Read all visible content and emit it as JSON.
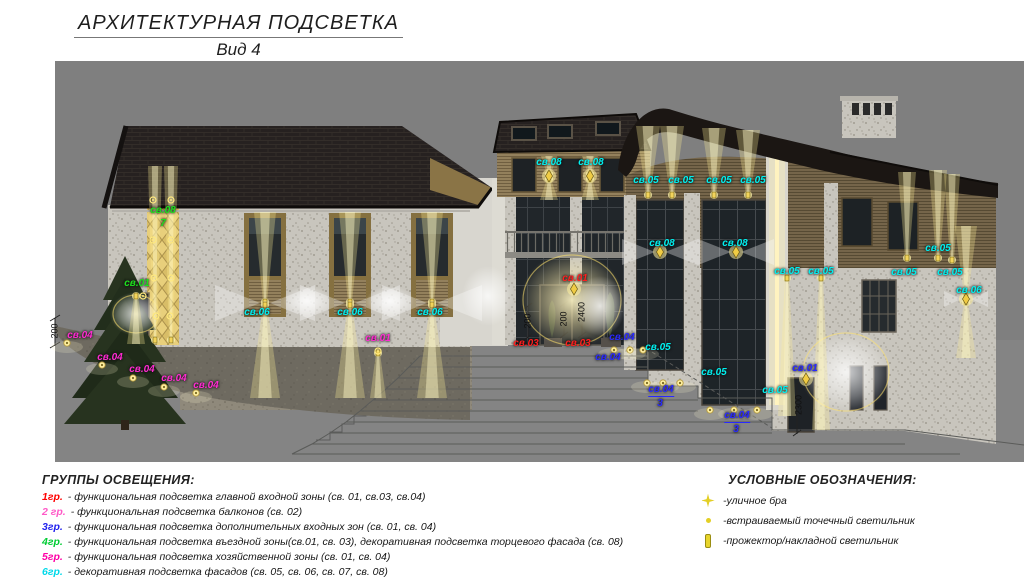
{
  "title": {
    "line1": "АРХИТЕКТУРНАЯ ПОДСВЕТКА",
    "line2": "Вид 4"
  },
  "groups_legend": {
    "header": "ГРУППЫ ОСВЕЩЕНИЯ:",
    "items": [
      {
        "code": "1гр.",
        "color": "#ff0000",
        "desc": "- функциональная подсветка главной входной зоны (св. 01, св.03, св.04)"
      },
      {
        "code": "2 гр.",
        "color": "#ff59c7",
        "desc": "- функциональная подсветка балконов (св. 02)"
      },
      {
        "code": "3гр.",
        "color": "#2222ee",
        "desc": "- функциональная подсветка дополнительных входных зон (св. 01, св. 04)"
      },
      {
        "code": "4гр.",
        "color": "#00cc33",
        "desc": "- функциональная подсветка въездной зоны(св.01, св. 03), декоративная подсветка торцевого фасада (св. 08)"
      },
      {
        "code": "5гр.",
        "color": "#ff00a6",
        "desc": "- функциональная подсветка хозяйственной зоны (св. 01, св. 04)"
      },
      {
        "code": "6гр.",
        "color": "#00d9e9",
        "desc": "- декоративная подсветка фасадов (св. 05, св. 06, св. 07, св. 08)"
      }
    ]
  },
  "symbols_legend": {
    "header": "УСЛОВНЫЕ ОБОЗНАЧЕНИЯ:",
    "items": [
      {
        "icon": "street-sconce-icon",
        "label": "-уличное бра"
      },
      {
        "icon": "recessed-point-icon",
        "label": "-встраиваемый точечный светильник"
      },
      {
        "icon": "floodlight-icon",
        "label": "-прожектор/накладной светильник"
      }
    ]
  },
  "annotations": [
    {
      "text": "св.08",
      "x": 163,
      "y": 211,
      "c": "#1de01d"
    },
    {
      "text": "7",
      "x": 163,
      "y": 224,
      "c": "#1de01d"
    },
    {
      "text": "св.01",
      "x": 137,
      "y": 284,
      "c": "#1de01d"
    },
    {
      "text": "св.04",
      "x": 80,
      "y": 336,
      "c": "#ff2bd1"
    },
    {
      "text": "св.04",
      "x": 110,
      "y": 358,
      "c": "#ff2bd1"
    },
    {
      "text": "св.04",
      "x": 142,
      "y": 370,
      "c": "#ff2bd1"
    },
    {
      "text": "св.04",
      "x": 174,
      "y": 379,
      "c": "#ff2bd1"
    },
    {
      "text": "св.04",
      "x": 206,
      "y": 386,
      "c": "#ff2bd1"
    },
    {
      "text": "св.01",
      "x": 378,
      "y": 339,
      "c": "#ff2bd1"
    },
    {
      "text": "св.06",
      "x": 257,
      "y": 313,
      "c": "#00f0f0"
    },
    {
      "text": "св.06",
      "x": 350,
      "y": 313,
      "c": "#00f0f0"
    },
    {
      "text": "св.06",
      "x": 430,
      "y": 313,
      "c": "#00f0f0"
    },
    {
      "text": "св.08",
      "x": 549,
      "y": 163,
      "c": "#00f0f0"
    },
    {
      "text": "св.08",
      "x": 591,
      "y": 163,
      "c": "#00f0f0"
    },
    {
      "text": "св.05",
      "x": 646,
      "y": 181,
      "c": "#00f0f0"
    },
    {
      "text": "св.05",
      "x": 681,
      "y": 181,
      "c": "#00f0f0"
    },
    {
      "text": "св.05",
      "x": 719,
      "y": 181,
      "c": "#00f0f0"
    },
    {
      "text": "св.05",
      "x": 753,
      "y": 181,
      "c": "#00f0f0"
    },
    {
      "text": "св.08",
      "x": 662,
      "y": 244,
      "c": "#00f0f0"
    },
    {
      "text": "св.08",
      "x": 735,
      "y": 244,
      "c": "#00f0f0"
    },
    {
      "text": "св.05",
      "x": 787,
      "y": 272,
      "c": "#00f0f0"
    },
    {
      "text": "св.05",
      "x": 821,
      "y": 272,
      "c": "#00f0f0"
    },
    {
      "text": "св.05",
      "x": 938,
      "y": 249,
      "c": "#00f0f0"
    },
    {
      "text": "св.05",
      "x": 904,
      "y": 273,
      "c": "#00f0f0"
    },
    {
      "text": "св.05",
      "x": 950,
      "y": 273,
      "c": "#00f0f0"
    },
    {
      "text": "св.06",
      "x": 969,
      "y": 291,
      "c": "#00f0f0"
    },
    {
      "text": "св.05",
      "x": 658,
      "y": 348,
      "c": "#00f0f0"
    },
    {
      "text": "св.05",
      "x": 714,
      "y": 373,
      "c": "#00f0f0"
    },
    {
      "text": "св.05",
      "x": 775,
      "y": 391,
      "c": "#00f0f0"
    },
    {
      "text": "св.01",
      "x": 575,
      "y": 279,
      "c": "#ff1f1f"
    },
    {
      "text": "св.03",
      "x": 526,
      "y": 344,
      "c": "#ff1f1f"
    },
    {
      "text": "св.03",
      "x": 578,
      "y": 344,
      "c": "#ff1f1f"
    },
    {
      "text": "св.04",
      "x": 622,
      "y": 338,
      "c": "#2929ff"
    },
    {
      "text": "св.04",
      "x": 608,
      "y": 358,
      "c": "#2929ff"
    },
    {
      "text": "св.04",
      "x": 661,
      "y": 391,
      "c": "#2929ff",
      "ul": true
    },
    {
      "text": "3",
      "x": 660,
      "y": 404,
      "c": "#2929ff"
    },
    {
      "text": "св.04",
      "x": 737,
      "y": 417,
      "c": "#2929ff",
      "ul": true
    },
    {
      "text": "3",
      "x": 736,
      "y": 430,
      "c": "#2929ff"
    },
    {
      "text": "св.01",
      "x": 805,
      "y": 369,
      "c": "#2929ff"
    }
  ],
  "dimensions": [
    {
      "text": "200",
      "x": 55,
      "y": 331
    },
    {
      "text": "200",
      "x": 528,
      "y": 321
    },
    {
      "text": "200",
      "x": 564,
      "y": 319
    },
    {
      "text": "2400",
      "x": 582,
      "y": 312
    },
    {
      "text": "2300",
      "x": 799,
      "y": 405
    }
  ],
  "lights": [
    {
      "t": "gy",
      "x": 572,
      "y": 300,
      "rx": 52,
      "ry": 48,
      "ring": 1
    },
    {
      "t": "gw",
      "x": 488,
      "y": 296,
      "rx": 26,
      "ry": 30
    },
    {
      "t": "gw",
      "x": 846,
      "y": 372,
      "rx": 46,
      "ry": 42,
      "ring": 1
    },
    {
      "t": "gw",
      "x": 136,
      "y": 314,
      "rx": 26,
      "ry": 22,
      "ring": 1
    },
    {
      "t": "gw",
      "x": 600,
      "y": 306,
      "rx": 26,
      "ry": 30
    },
    {
      "t": "gw",
      "x": 307,
      "y": 301,
      "rx": 24,
      "ry": 15
    },
    {
      "t": "gw",
      "x": 390,
      "y": 301,
      "rx": 24,
      "ry": 15
    },
    {
      "t": "ub",
      "x": 155,
      "y1": 340,
      "y2": 166,
      "w": 7
    },
    {
      "t": "ub",
      "x": 171,
      "y1": 340,
      "y2": 166,
      "w": 7
    },
    {
      "t": "ub",
      "x": 265,
      "y1": 302,
      "y2": 212,
      "w": 11
    },
    {
      "t": "ub",
      "x": 350,
      "y1": 302,
      "y2": 212,
      "w": 11
    },
    {
      "t": "ub",
      "x": 432,
      "y1": 302,
      "y2": 212,
      "w": 11
    },
    {
      "t": "ub",
      "x": 648,
      "y1": 195,
      "y2": 126,
      "w": 12
    },
    {
      "t": "ub",
      "x": 672,
      "y1": 195,
      "y2": 126,
      "w": 12
    },
    {
      "t": "ub",
      "x": 714,
      "y1": 195,
      "y2": 128,
      "w": 12
    },
    {
      "t": "ub",
      "x": 748,
      "y1": 195,
      "y2": 130,
      "w": 12
    },
    {
      "t": "ub",
      "x": 907,
      "y1": 258,
      "y2": 172,
      "w": 9
    },
    {
      "t": "ub",
      "x": 938,
      "y1": 258,
      "y2": 170,
      "w": 9
    },
    {
      "t": "ub",
      "x": 952,
      "y1": 260,
      "y2": 174,
      "w": 8
    },
    {
      "t": "ub",
      "x": 549,
      "y1": 174,
      "y2": 156,
      "w": 8
    },
    {
      "t": "ub",
      "x": 590,
      "y1": 174,
      "y2": 156,
      "w": 8
    },
    {
      "t": "ub",
      "x": 966,
      "y1": 296,
      "y2": 226,
      "w": 11
    },
    {
      "t": "db",
      "x": 265,
      "y1": 305,
      "y2": 398,
      "w": 15
    },
    {
      "t": "db",
      "x": 350,
      "y1": 305,
      "y2": 398,
      "w": 15
    },
    {
      "t": "db",
      "x": 432,
      "y1": 305,
      "y2": 398,
      "w": 15
    },
    {
      "t": "db",
      "x": 549,
      "y1": 179,
      "y2": 200,
      "w": 9
    },
    {
      "t": "db",
      "x": 590,
      "y1": 179,
      "y2": 200,
      "w": 9
    },
    {
      "t": "db",
      "x": 966,
      "y1": 302,
      "y2": 358,
      "w": 10
    },
    {
      "t": "db",
      "x": 787,
      "y1": 278,
      "y2": 416,
      "w": 9
    },
    {
      "t": "db",
      "x": 821,
      "y1": 278,
      "y2": 430,
      "w": 9
    },
    {
      "t": "db",
      "x": 136,
      "y1": 296,
      "y2": 344,
      "w": 9
    },
    {
      "t": "db",
      "x": 378,
      "y1": 353,
      "y2": 398,
      "w": 8
    },
    {
      "t": "bf",
      "x": 265,
      "y": 303,
      "s": 50,
      "h": 18
    },
    {
      "t": "bf",
      "x": 350,
      "y": 303,
      "s": 50,
      "h": 18
    },
    {
      "t": "bf",
      "x": 432,
      "y": 303,
      "s": 50,
      "h": 18
    },
    {
      "t": "bf",
      "x": 660,
      "y": 252,
      "s": 38,
      "h": 13
    },
    {
      "t": "bf",
      "x": 736,
      "y": 252,
      "s": 38,
      "h": 13
    },
    {
      "t": "bf",
      "x": 966,
      "y": 299,
      "s": 22,
      "h": 8
    },
    {
      "t": "sc",
      "x": 574,
      "y": 289
    },
    {
      "t": "sc",
      "x": 806,
      "y": 379
    },
    {
      "t": "sc",
      "x": 966,
      "y": 299
    },
    {
      "t": "sc",
      "x": 660,
      "y": 252
    },
    {
      "t": "sc",
      "x": 736,
      "y": 252
    },
    {
      "t": "sc",
      "x": 549,
      "y": 176
    },
    {
      "t": "sc",
      "x": 590,
      "y": 176
    },
    {
      "t": "ring",
      "x": 143,
      "y": 296
    },
    {
      "t": "ring",
      "x": 378,
      "y": 351
    },
    {
      "t": "ring",
      "x": 153,
      "y": 200
    },
    {
      "t": "ring",
      "x": 171,
      "y": 200
    },
    {
      "t": "ring",
      "x": 153,
      "y": 240
    },
    {
      "t": "ring",
      "x": 171,
      "y": 240
    },
    {
      "t": "ring",
      "x": 154,
      "y": 278
    },
    {
      "t": "ring",
      "x": 171,
      "y": 278
    },
    {
      "t": "ring",
      "x": 156,
      "y": 316
    },
    {
      "t": "ring",
      "x": 170,
      "y": 316
    },
    {
      "t": "dot",
      "x": 67,
      "y": 343
    },
    {
      "t": "dot",
      "x": 102,
      "y": 365
    },
    {
      "t": "dot",
      "x": 133,
      "y": 378
    },
    {
      "t": "dot",
      "x": 164,
      "y": 387
    },
    {
      "t": "dot",
      "x": 196,
      "y": 393
    },
    {
      "t": "dot",
      "x": 614,
      "y": 350
    },
    {
      "t": "dot",
      "x": 630,
      "y": 350
    },
    {
      "t": "dot",
      "x": 643,
      "y": 350
    },
    {
      "t": "dot",
      "x": 647,
      "y": 383
    },
    {
      "t": "dot",
      "x": 663,
      "y": 383
    },
    {
      "t": "dot",
      "x": 680,
      "y": 383
    },
    {
      "t": "dot",
      "x": 710,
      "y": 410
    },
    {
      "t": "dot",
      "x": 734,
      "y": 410
    },
    {
      "t": "dot",
      "x": 757,
      "y": 410
    }
  ],
  "palette": {
    "canvas_gray": "#7f7f7f",
    "beam_yellow": "#fff0a0",
    "label_cyan": "#00f0f0",
    "label_green": "#1de01d",
    "label_red": "#ff1f1f",
    "label_blue": "#2929ff",
    "label_magenta": "#ff2bd1"
  }
}
